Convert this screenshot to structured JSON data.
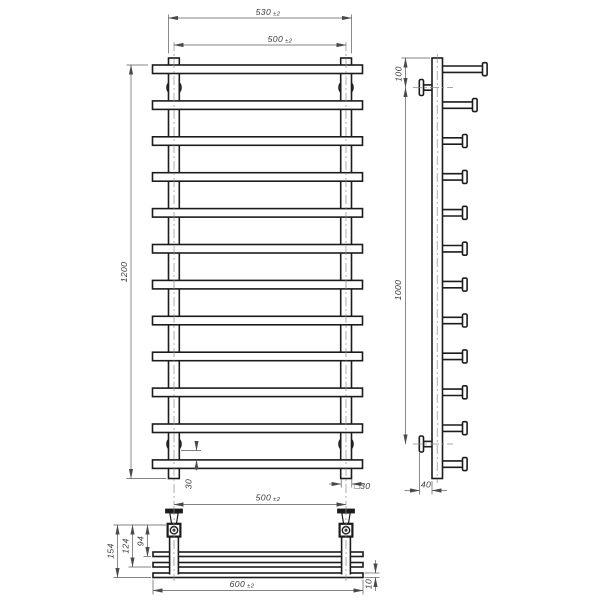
{
  "drawing_title": "ladder-towel-rail-technical-drawing",
  "front_view": {
    "bar_count": 12,
    "dim_width_outer": {
      "value": "530",
      "tol": "±2"
    },
    "dim_width_centers": {
      "value": "500",
      "tol": "±2"
    },
    "dim_height": {
      "value": "1200"
    },
    "dim_mount_to_bottom_bar": {
      "value": "30"
    },
    "dim_bottom_centers": {
      "value": "500",
      "tol": "±2"
    },
    "post_section_label": {
      "value": "□30"
    }
  },
  "side_view": {
    "peg_count": 12,
    "dim_top_to_mount": {
      "value": "100"
    },
    "dim_mount_span": {
      "value": "1000"
    },
    "dim_wall_offset": {
      "value": "40"
    }
  },
  "bottom_view": {
    "bar_depth_rows": 3,
    "dim_depth_outer": {
      "value": "154"
    },
    "dim_depth_middle": {
      "value": "124"
    },
    "dim_depth_inner": {
      "value": "94"
    },
    "dim_overall_width": {
      "value": "600",
      "tol": "±2"
    },
    "dim_bar_thickness": {
      "value": "10"
    }
  },
  "colors": {
    "line": "#1c1c1c",
    "dim_line": "#5a5a5a",
    "background": "#ffffff"
  }
}
